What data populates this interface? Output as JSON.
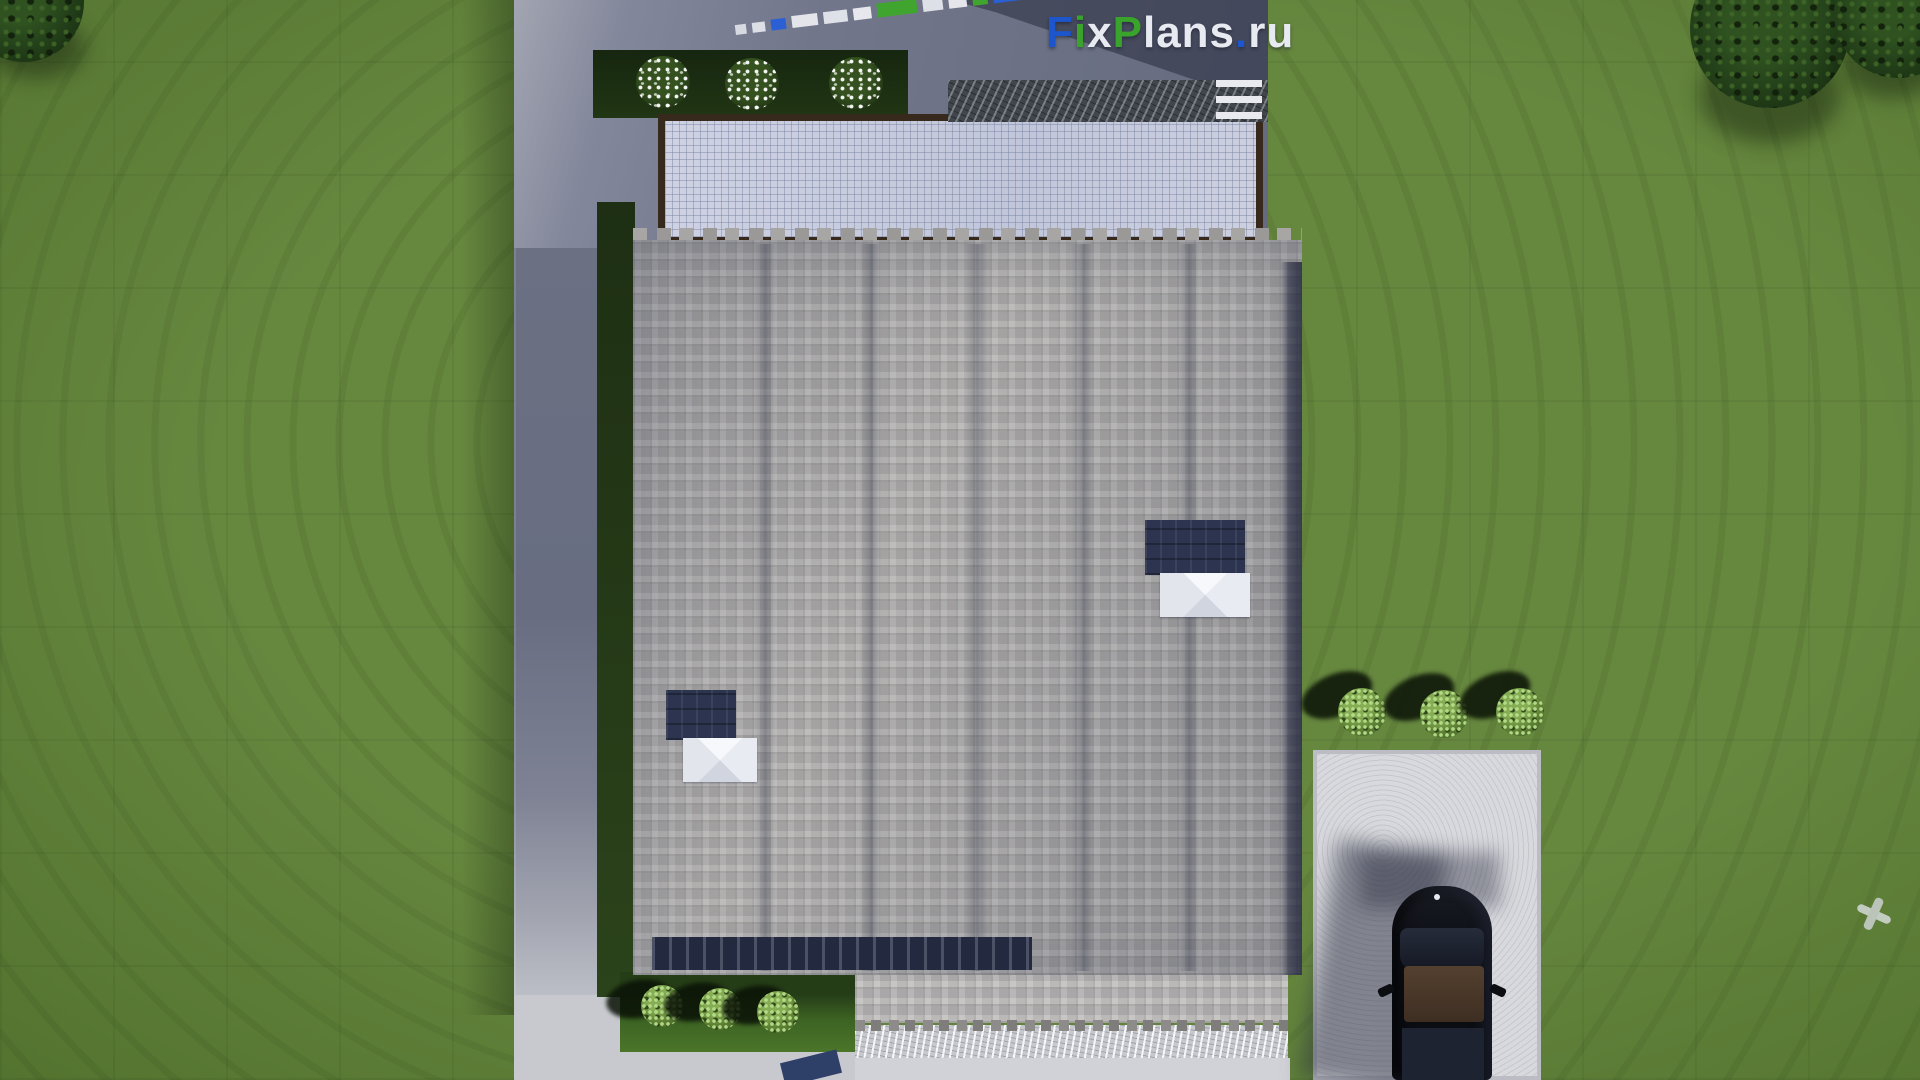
{
  "watermark": {
    "text": "FixPlans.ru",
    "segments": [
      {
        "t": "F",
        "c": "#1d55cd"
      },
      {
        "t": "i",
        "c": "#3aa32c"
      },
      {
        "t": "x",
        "c": "#e8eaf1"
      },
      {
        "t": "P",
        "c": "#3aa32c"
      },
      {
        "t": "lans",
        "c": "#e8eaf1"
      },
      {
        "t": ".",
        "c": "#1d55cd"
      },
      {
        "t": "ru",
        "c": "#e8eaf1"
      }
    ]
  },
  "scene": {
    "description": "Aerial top-down 3D render of a house site plan",
    "objects": [
      "gray-shingle-roof",
      "glass-canopy-terrace",
      "stone-bench",
      "garden-beds",
      "concrete-path",
      "white-driveway",
      "black-suv-car",
      "skylights",
      "ornamental-bushes",
      "flowering-shrubs",
      "trees",
      "lawn"
    ]
  },
  "palette": {
    "lawn": "#5e8136",
    "roof": "#a7a5a4",
    "roof_shadow": "#232a40",
    "canopy": "#c7cbde",
    "canopy_frame": "#38291d",
    "concrete_shaded": "#6b7083",
    "concrete_lit": "#d0d2d7",
    "driveway": "#d8d9dd",
    "car": "#0d0f15",
    "car_sunroof": "#53402f",
    "logo_blue": "#1d55cd",
    "logo_green": "#3aa32c"
  },
  "decor": {
    "diagonal_watermark": {
      "segments": [
        {
          "w": 11,
          "h": 10,
          "c": "#d7dae1"
        },
        {
          "w": 13,
          "h": 10,
          "c": "#dcdfe6"
        },
        {
          "w": 15,
          "h": 11,
          "c": "#2a60d4"
        },
        {
          "w": 26,
          "h": 12,
          "c": "#e3e5eb"
        },
        {
          "w": 24,
          "h": 12,
          "c": "#dfe1e8"
        },
        {
          "w": 18,
          "h": 12,
          "c": "#e6e8ee"
        },
        {
          "w": 40,
          "h": 14,
          "c": "#3fa52f"
        },
        {
          "w": 20,
          "h": 13,
          "c": "#dde0e7"
        },
        {
          "w": 18,
          "h": 13,
          "c": "#e4e6ec"
        },
        {
          "w": 15,
          "h": 14,
          "c": "#3fa52f"
        },
        {
          "w": 30,
          "h": 27,
          "c": "#2a60d4"
        }
      ]
    },
    "roof_seams_x": [
      120,
      226,
      332,
      438,
      544
    ],
    "right_bushes": [
      [
        1362,
        712
      ],
      [
        1444,
        714
      ],
      [
        1520,
        712
      ]
    ],
    "bottom_left_bushes": [
      [
        662,
        1006
      ],
      [
        720,
        1009
      ],
      [
        778,
        1012
      ]
    ],
    "flower_bushes": [
      [
        663,
        82
      ],
      [
        752,
        84
      ],
      [
        856,
        83
      ]
    ],
    "bench_steps": [
      [
        1216,
        80
      ],
      [
        1216,
        96
      ],
      [
        1216,
        112
      ]
    ],
    "trees": [
      {
        "cx": 1770,
        "cy": 28,
        "r": 80,
        "sx": 1700,
        "sy": 48,
        "sw": 140,
        "sh": 95
      },
      {
        "cx": 1898,
        "cy": 14,
        "r": 64,
        "sx": 1842,
        "sy": 28,
        "sw": 100,
        "sh": 70
      },
      {
        "cx": 24,
        "cy": 2,
        "r": 60,
        "sx": -10,
        "sy": 18,
        "sw": 95,
        "sh": 60
      }
    ]
  }
}
